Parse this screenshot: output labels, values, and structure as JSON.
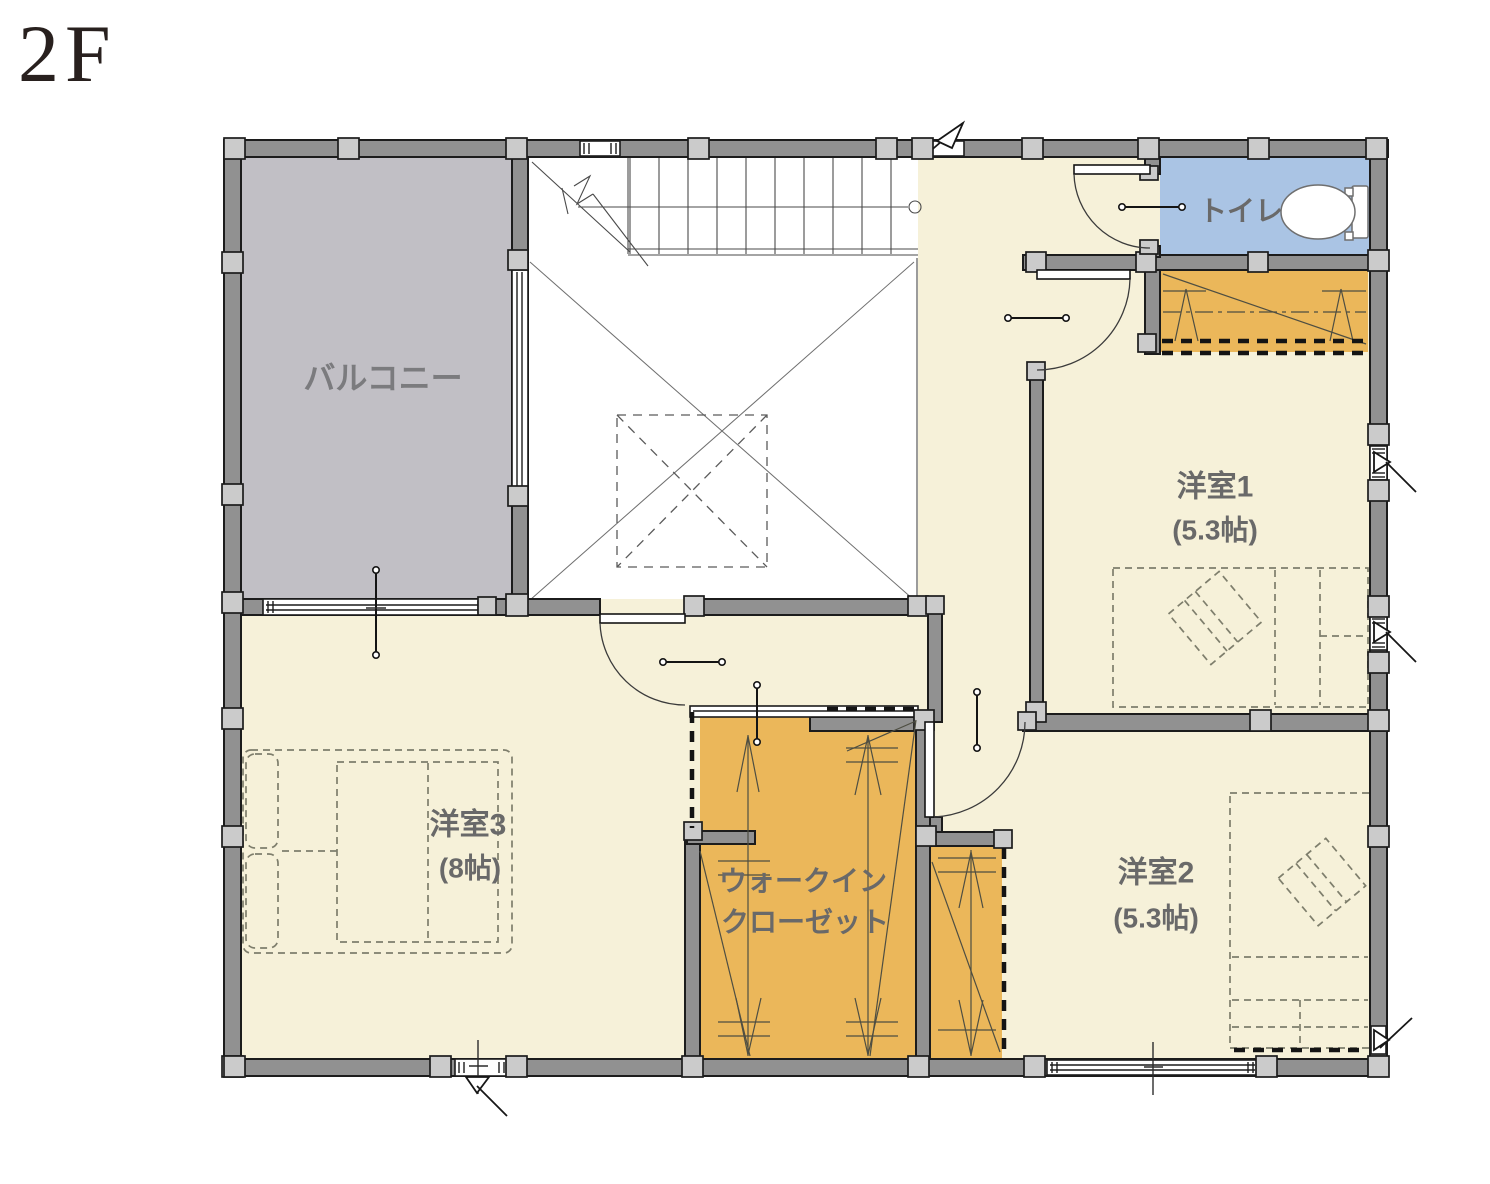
{
  "title": "2F",
  "rooms": {
    "balcony": {
      "label": "バルコニー"
    },
    "toilet": {
      "label": "トイレ"
    },
    "bedroom1": {
      "label": "洋室1",
      "size": "(5.3帖)"
    },
    "bedroom2": {
      "label": "洋室2",
      "size": "(5.3帖)"
    },
    "bedroom3": {
      "label": "洋室3",
      "size": "(8帖)"
    },
    "wic": {
      "label_line1": "ウォークイン",
      "label_line2": "クローゼット"
    }
  },
  "colors": {
    "floor": "#F6F1D9",
    "closet_fill": "#EBB75A",
    "toilet_fill": "#AAC4E4",
    "balcony_fill": "#C1BFC5",
    "wall_fill": "#919191",
    "post_fill": "#CBCBCB",
    "room_label_text": "#696969",
    "balcony_label_text": "#7B7B7E",
    "title_text": "#28201E"
  }
}
